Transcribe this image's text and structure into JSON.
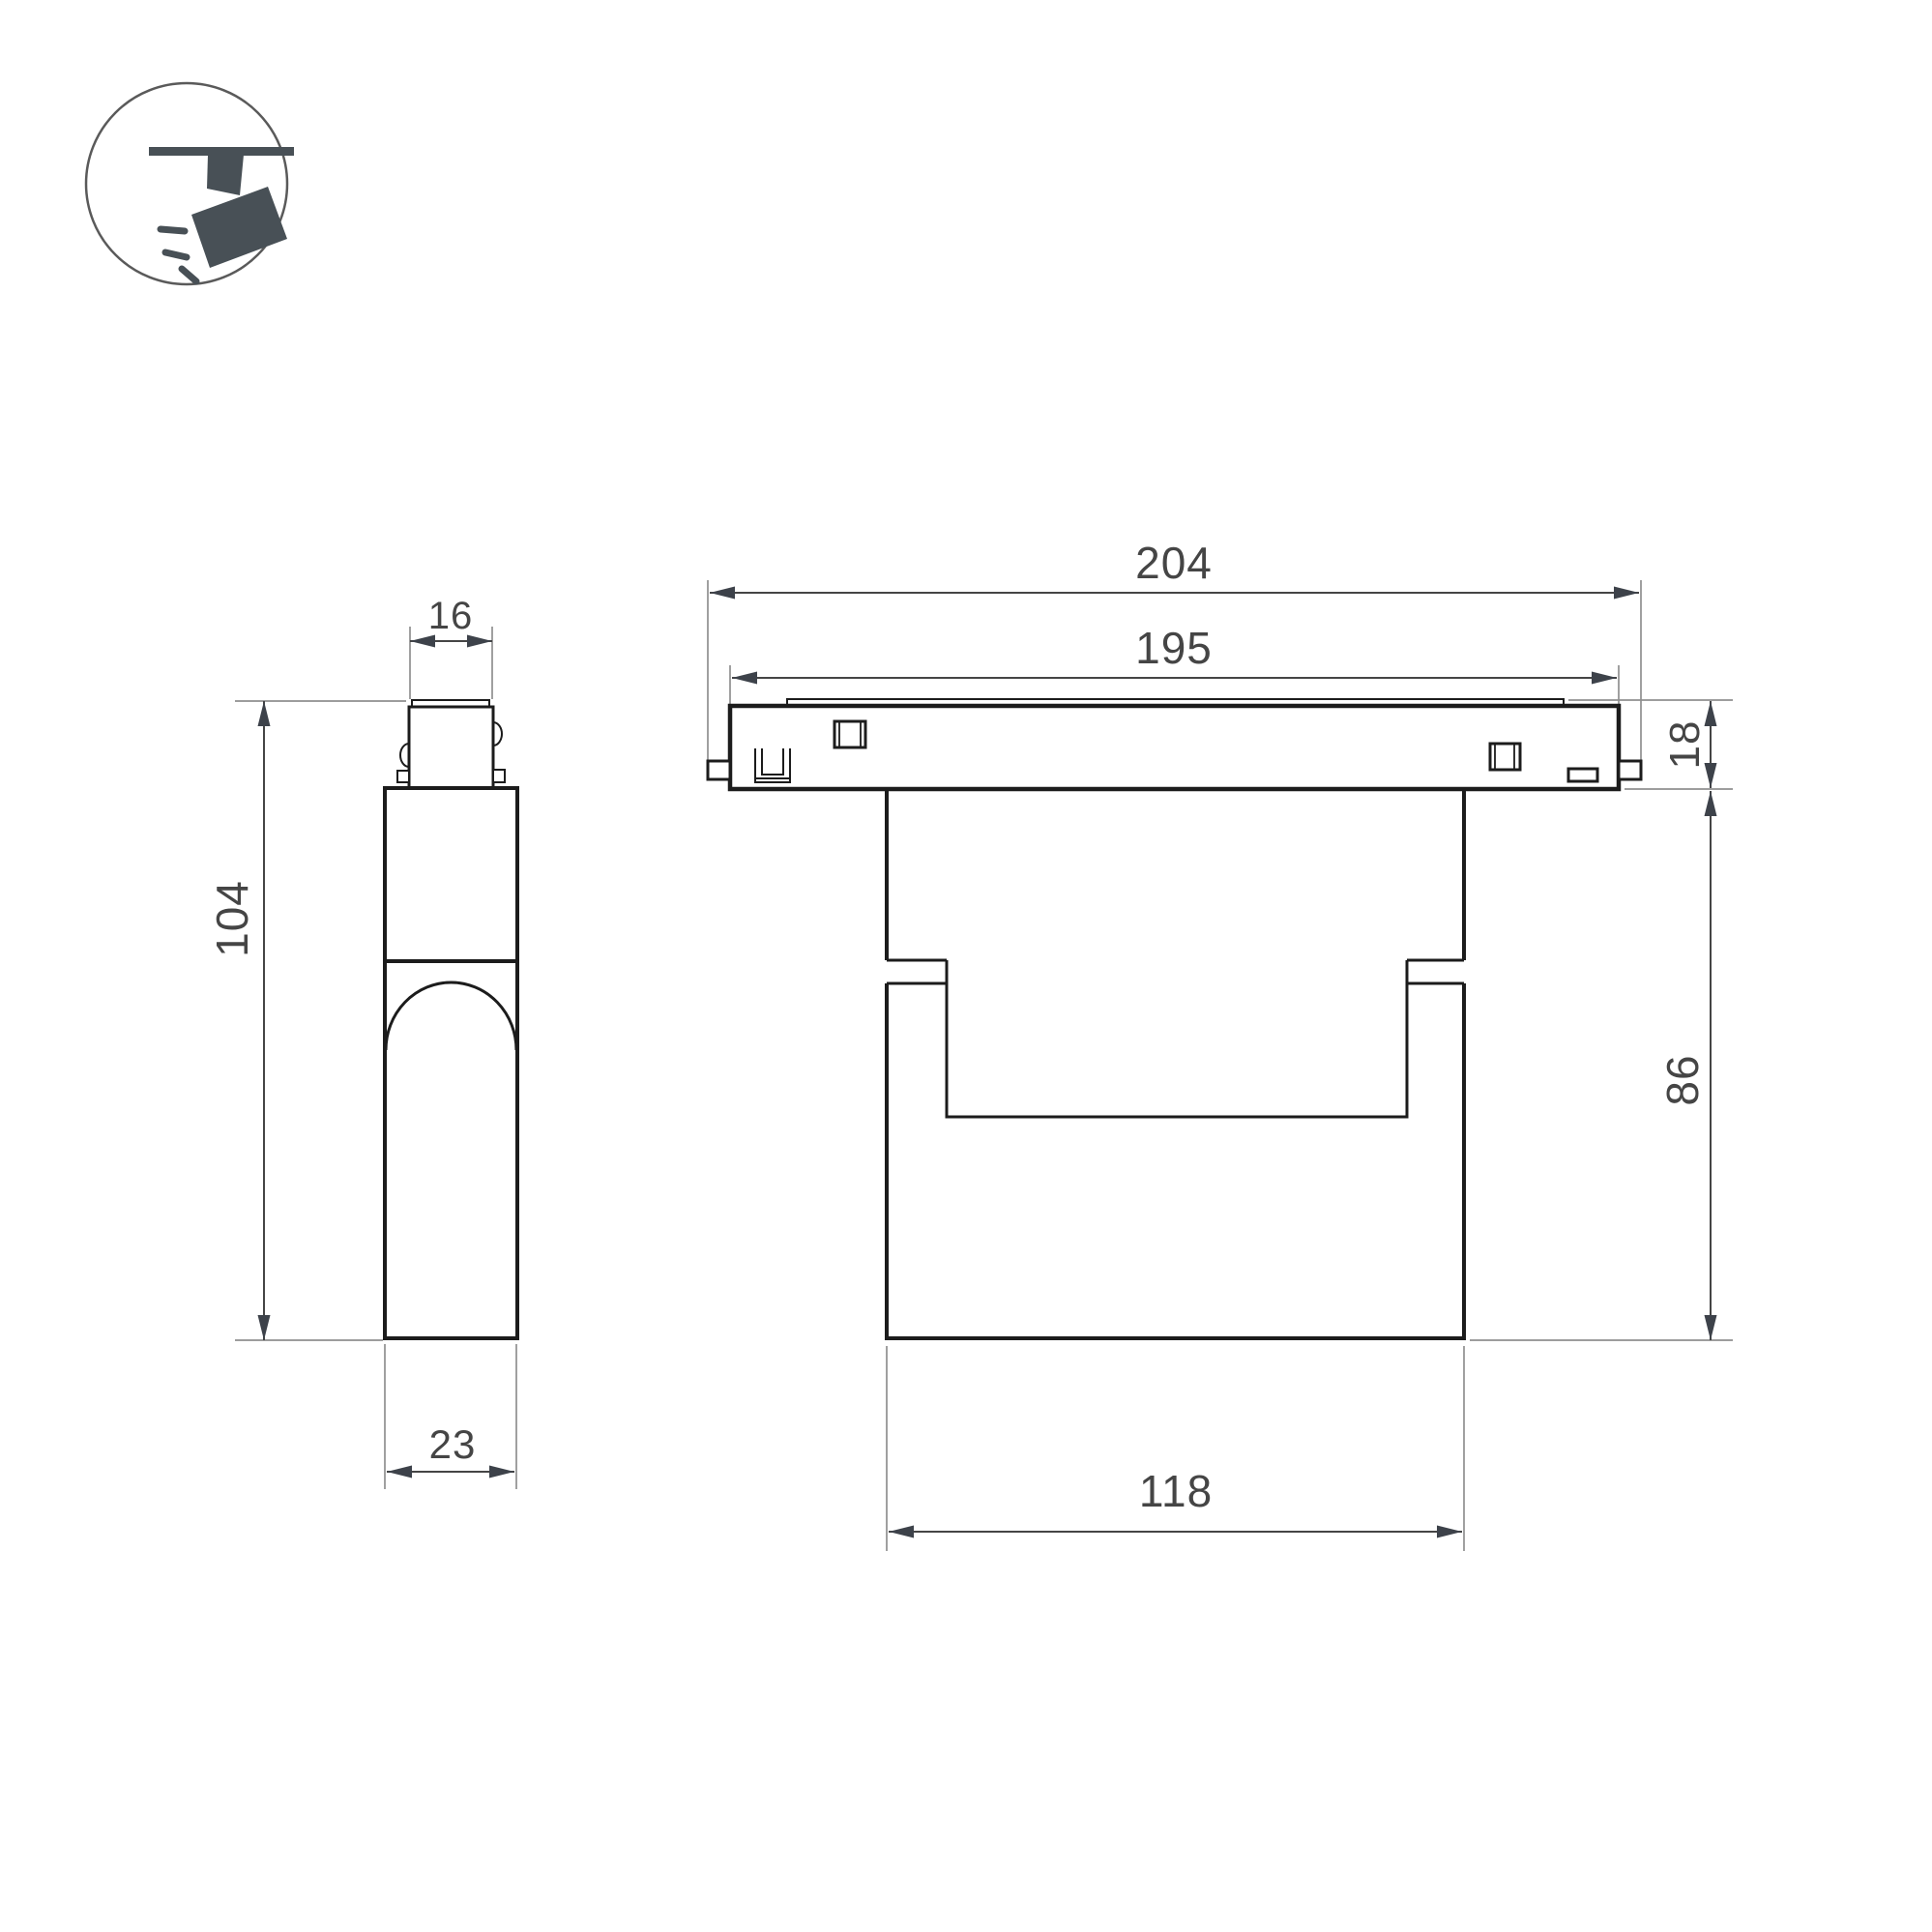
{
  "drawing": {
    "type": "technical-dimension-drawing",
    "subject": "magnetic track spotlight luminaire, side and front orthographic views",
    "views": {
      "side_view": "left orthographic projection with track adapter, body and lens dome",
      "front_view": "right orthographic projection with track rail, clips and lamp body"
    }
  },
  "legend_icon": {
    "name": "ceiling-track-spotlight",
    "description": "circled pictogram of a spotlight hanging from a track, tilted head with light rays"
  },
  "dimensions_mm": {
    "adapter_width": "16",
    "overall_height": "104",
    "body_depth": "23",
    "track_length_overall": "204",
    "track_length_body": "195",
    "track_height": "18",
    "body_height": "86",
    "body_width": "118"
  },
  "colors": {
    "bg": "#ffffff",
    "line": "#1c1c1c",
    "dimline": "#454545",
    "extline": "#8f8f8f",
    "arrow": "#3d424a",
    "text": "#454545",
    "icon": "#485056",
    "iconring": "#5a5a5a"
  }
}
